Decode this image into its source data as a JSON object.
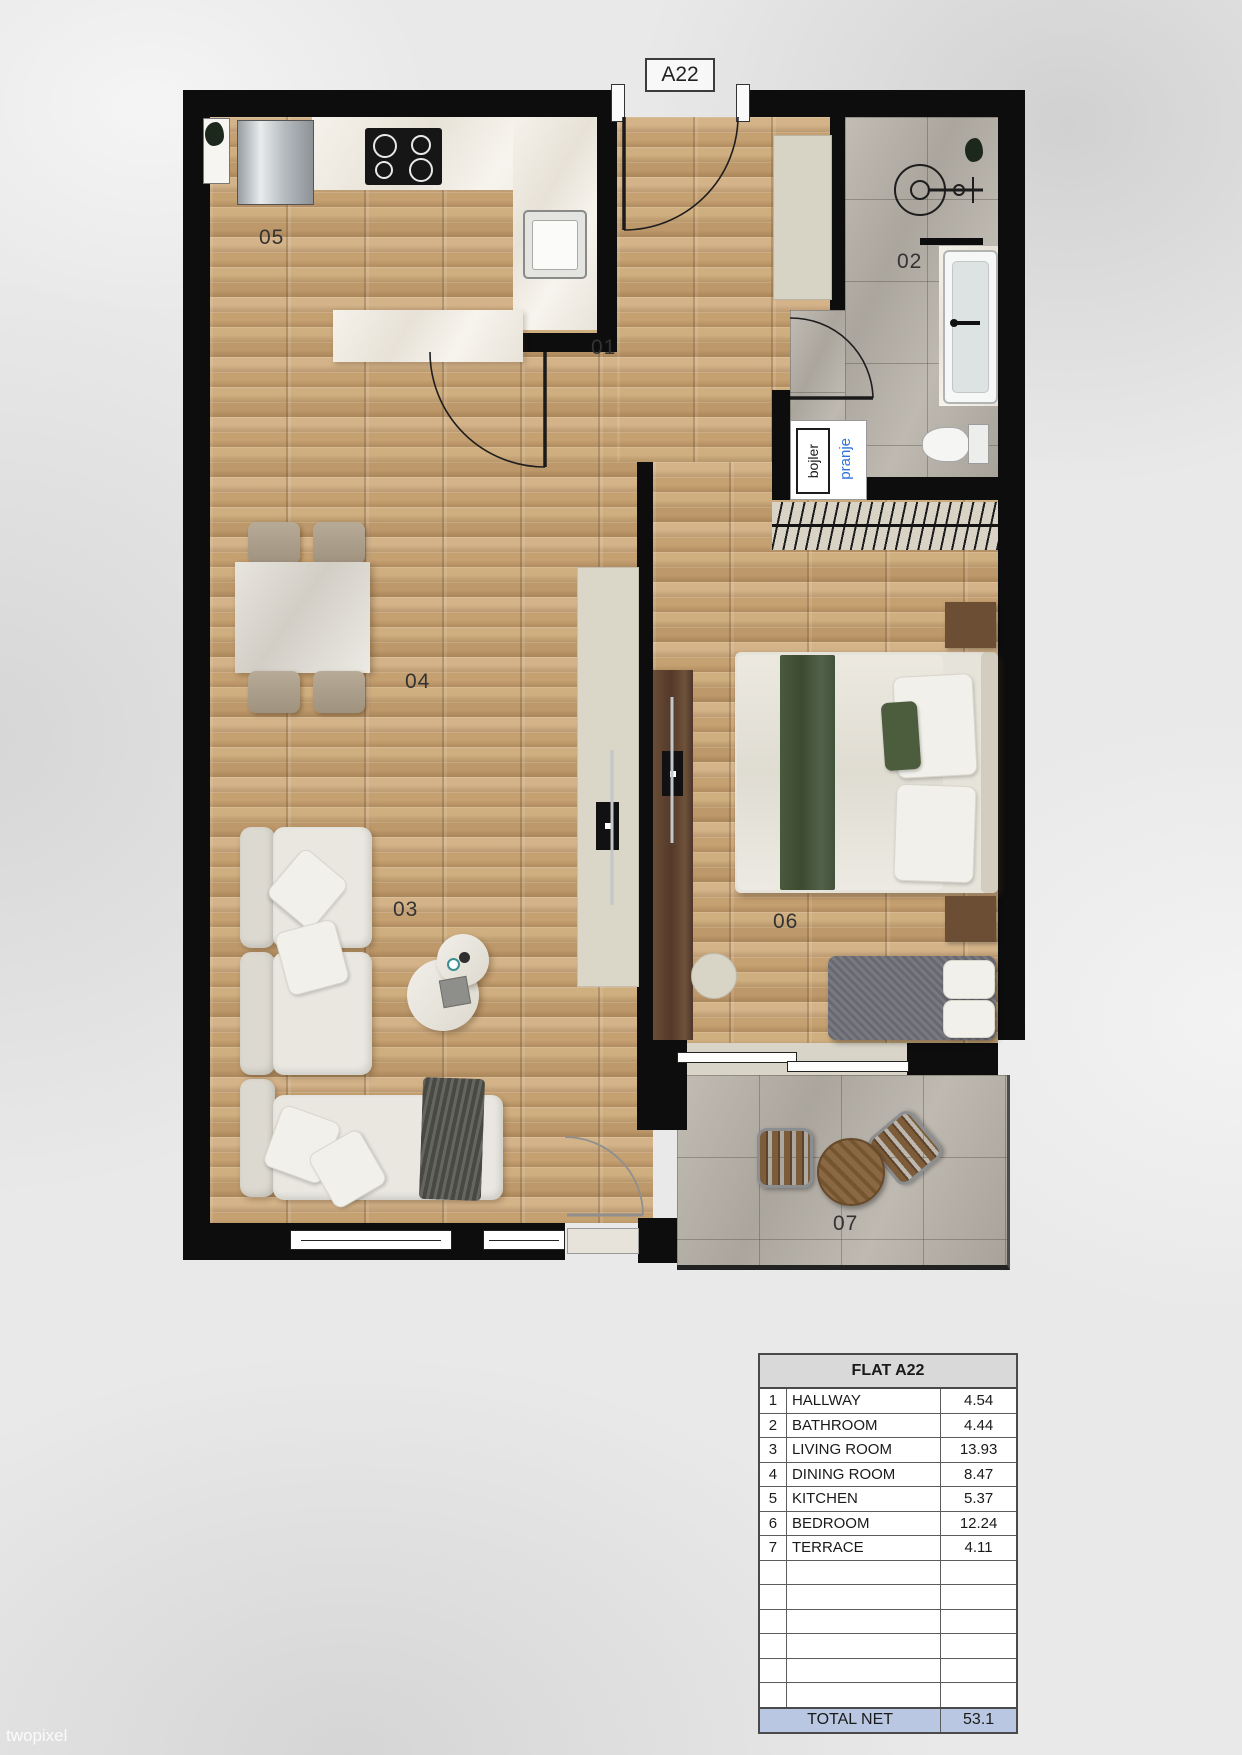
{
  "canvas": {
    "width": 1242,
    "height": 1755,
    "background": "#e9e9e9"
  },
  "plan": {
    "unit_label": "A22",
    "room_labels": {
      "hallway": "01",
      "bathroom": "02",
      "living_room": "03",
      "dining_room": "04",
      "kitchen": "05",
      "bedroom": "06",
      "terrace": "07"
    },
    "annotations": {
      "boiler": "bojler",
      "laundry": "pranje"
    },
    "colors": {
      "wall": "#0d0d0d",
      "wood_floor": "#c9a678",
      "tile_floor": "#b6b1a9",
      "marble": "#f2efe8",
      "laundry_text": "#2f72d9"
    }
  },
  "area_table": {
    "title": "FLAT A22",
    "rows": [
      {
        "num": "1",
        "name": "HALLWAY",
        "value": "4.54"
      },
      {
        "num": "2",
        "name": "BATHROOM",
        "value": "4.44"
      },
      {
        "num": "3",
        "name": "LIVING ROOM",
        "value": "13.93"
      },
      {
        "num": "4",
        "name": "DINING ROOM",
        "value": "8.47"
      },
      {
        "num": "5",
        "name": "KITCHEN",
        "value": "5.37"
      },
      {
        "num": "6",
        "name": "BEDROOM",
        "value": "12.24"
      },
      {
        "num": "7",
        "name": "TERRACE",
        "value": "4.11"
      }
    ],
    "total": {
      "label": "TOTAL NET",
      "value": "53.1"
    },
    "colors": {
      "header_bg": "#d9d9d9",
      "total_bg": "#b9c7e2"
    }
  },
  "watermark": "twopixel"
}
